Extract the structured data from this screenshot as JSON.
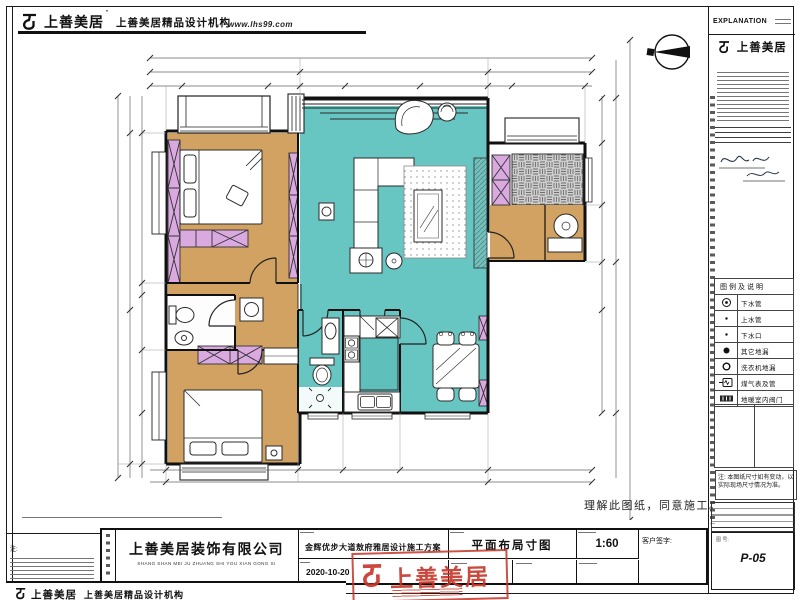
{
  "sheet": {
    "header": {
      "brand": "上善美居",
      "reg": "”",
      "tagline": "上善美居精品设计机构",
      "website": "www.lhs99.com"
    },
    "statement": "理解此图纸，同意施工。",
    "left_note_label": "注:",
    "footer": {
      "brand": "上善美居",
      "tagline": "上善美居精品设计机构"
    }
  },
  "sidebar": {
    "explanation": "EXPLANATION",
    "brand": "上善美居",
    "legend": {
      "title": "图例及说明",
      "rows": [
        {
          "icon": "drain-double-circle",
          "label": "下水管"
        },
        {
          "icon": "small-dot",
          "label": "上水管"
        },
        {
          "icon": "small-dot",
          "label": "下水口"
        },
        {
          "icon": "filled-circle",
          "label": "其它地漏"
        },
        {
          "icon": "open-circle",
          "label": "洗衣机地漏"
        },
        {
          "icon": "gas-meter",
          "label": "煤气表及管"
        },
        {
          "icon": "indoor-valve",
          "label": "地暖室内阀门"
        }
      ]
    },
    "note": "注: 本图纸尺寸如有变动，以实际现场尺寸情况为准。",
    "sheet_no_label": "图 号:",
    "sheet_no": "P-05"
  },
  "titleblock": {
    "company": "上善美居装饰有限公司",
    "company_pinyin": "SHANG SHAN MEI JU ZHUANG SHI YOU XIAN GONG SI",
    "project": "金辉优步大道敖府雅居设计施工方案",
    "date": "2020-10-20",
    "drawing_title": "平面布局寸图",
    "scale": "1:60",
    "client_sign_label": "客户签字:",
    "stamp_brand": "上善美居"
  }
}
